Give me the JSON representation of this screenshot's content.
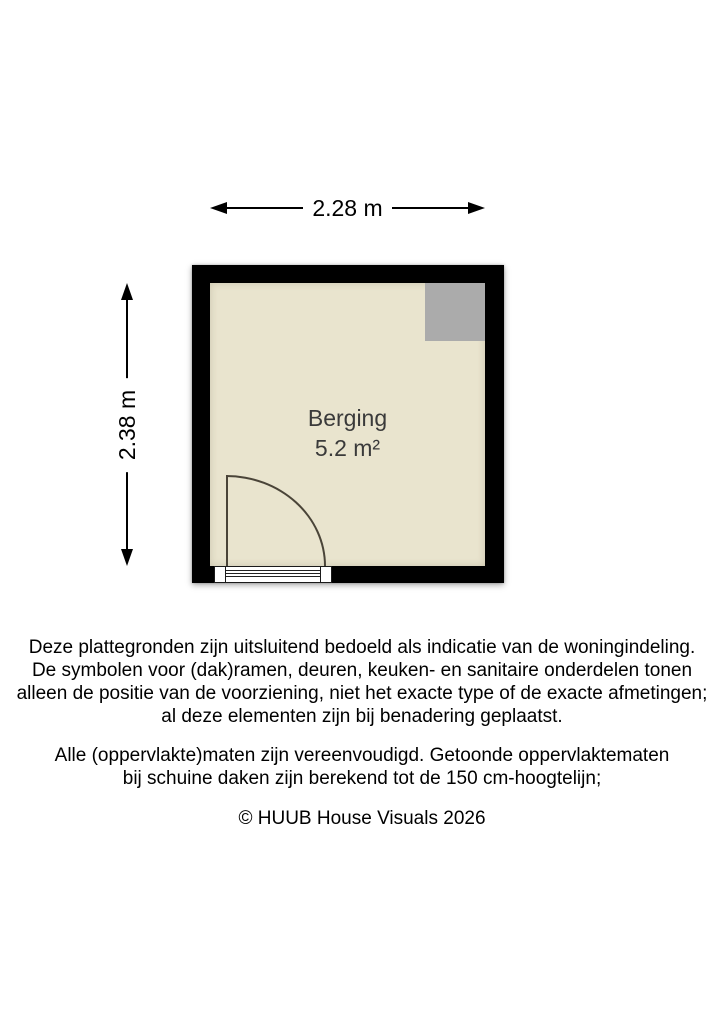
{
  "floorplan": {
    "width_label": "2.28 m",
    "height_label": "2.38 m",
    "room": {
      "name": "Berging",
      "area": "5.2 m²"
    }
  },
  "disclaimer": {
    "paragraph1": [
      "Deze plattegronden zijn uitsluitend bedoeld als indicatie van de woningindeling.",
      "De symbolen voor (dak)ramen, deuren, keuken- en sanitaire onderdelen tonen",
      "alleen de positie van de voorziening, niet het exacte type of de exacte afmetingen;",
      "al deze elementen zijn bij benadering geplaatst."
    ],
    "paragraph2": [
      "Alle (oppervlakte)maten zijn vereenvoudigd. Getoonde oppervlaktematen",
      "bij schuine daken zijn berekend tot de 150 cm-hoogtelijn;"
    ],
    "copyright": "© HUUB House Visuals 2026"
  },
  "colors": {
    "wall": "#000000",
    "floor": "#e9e4ce",
    "corner_block": "#ababab",
    "door": "#4a4438"
  }
}
